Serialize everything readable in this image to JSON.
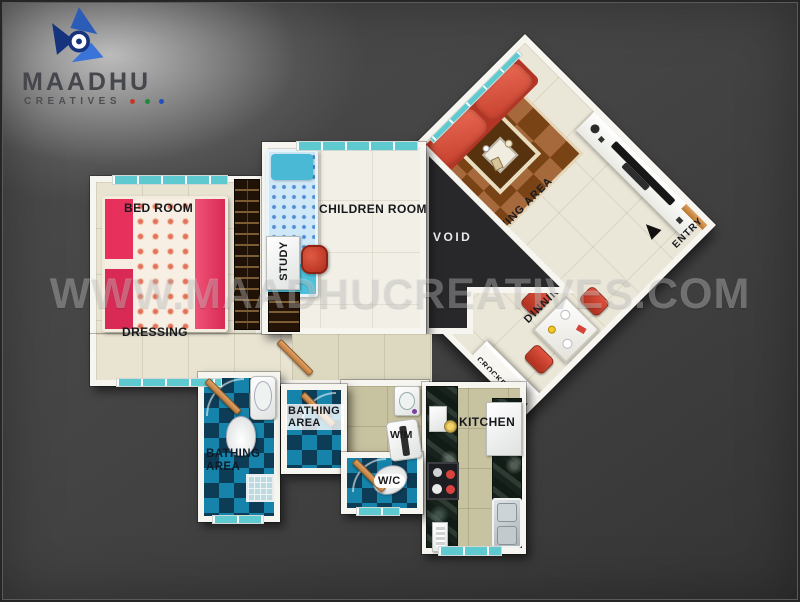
{
  "logo": {
    "brand": "MAADHU",
    "subtitle": "CREATIVES",
    "dot_colors": [
      "#c0392b",
      "#1e8a3c",
      "#1f4fc2"
    ],
    "mark_colors": [
      "#2a5cb8",
      "#16337e",
      "#3a74d8"
    ]
  },
  "watermark": "WWW.MAADHUCREATIVES.COM",
  "labels": {
    "bedroom": "BED ROOM",
    "children": "CHILDREN ROOM",
    "study": "STUDY",
    "void": "VOID",
    "living": "LIVING AREA",
    "entry": "ENTRY",
    "dining": "DINNING",
    "dressing": "DRESSING",
    "bathing1": "BATHING AREA",
    "bathing2": "BATHING AREA",
    "wm": "W/M",
    "wc": "W/C",
    "kitchen": "KITCHEN",
    "crockery": "CROCKERY UNIT"
  },
  "colors": {
    "wall": "#f7f5ef",
    "floor_cream": "#e9e4d2",
    "floor_olive": "#c7c2a0",
    "bath_tile_dark": "#0d3d56",
    "bath_tile_teal": "#1583aa",
    "sofa_red": "#c43f2c",
    "bed_pink": "#e23a5e",
    "bed_blue": "#53c3dd",
    "window_teal": "#7fd4d6",
    "background": "#3f3f3f"
  }
}
